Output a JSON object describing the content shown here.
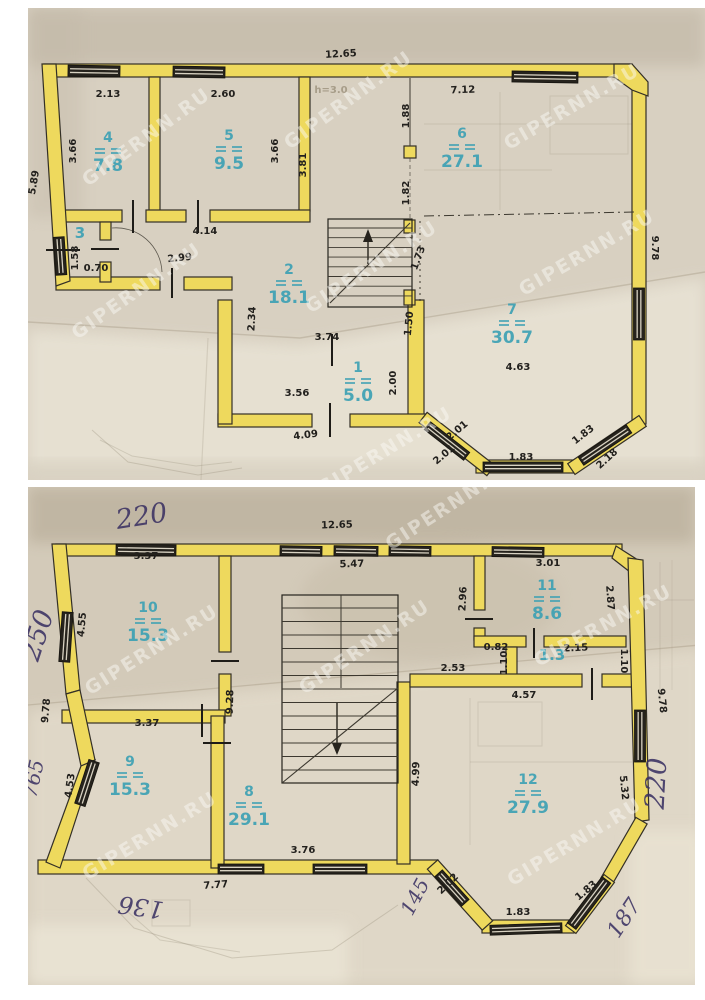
{
  "watermark_text": "GIPERNN.RU",
  "colors": {
    "wall_yellow": "#eed95d",
    "room_label_teal": "#3aa0b4",
    "dimension_ink": "#22201d",
    "handwriting_ink": "#3b3263"
  },
  "floor1": {
    "rooms": [
      {
        "num": "1",
        "area": "5.0",
        "x": 358,
        "y": 372
      },
      {
        "num": "2",
        "area": "18.1",
        "x": 289,
        "y": 274
      },
      {
        "num": "3",
        "x": 80,
        "y": 238
      },
      {
        "num": "4",
        "area": "7.8",
        "x": 108,
        "y": 142
      },
      {
        "num": "5",
        "area": "9.5",
        "x": 229,
        "y": 140
      },
      {
        "num": "6",
        "area": "27.1",
        "x": 462,
        "y": 138
      },
      {
        "num": "7",
        "area": "30.7",
        "x": 512,
        "y": 314
      }
    ],
    "dims": [
      {
        "t": "12.65",
        "x": 341,
        "y": 57,
        "r": -3
      },
      {
        "t": "2.13",
        "x": 108,
        "y": 97
      },
      {
        "t": "2.60",
        "x": 223,
        "y": 97
      },
      {
        "t": "h=3.0",
        "x": 331,
        "y": 93,
        "ghost": true
      },
      {
        "t": "7.12",
        "x": 463,
        "y": 93,
        "r": -2
      },
      {
        "t": "3.66",
        "x": 76,
        "y": 151,
        "r": -90
      },
      {
        "t": "3.66",
        "x": 278,
        "y": 151,
        "r": -90
      },
      {
        "t": "3.81",
        "x": 306,
        "y": 165,
        "r": -90
      },
      {
        "t": "5.89",
        "x": 37,
        "y": 183,
        "r": -80
      },
      {
        "t": "1.88",
        "x": 409,
        "y": 116,
        "r": -90
      },
      {
        "t": "1.82",
        "x": 409,
        "y": 193,
        "r": -90
      },
      {
        "t": "1.73",
        "x": 421,
        "y": 259,
        "r": -70
      },
      {
        "t": "1.50",
        "x": 412,
        "y": 324,
        "r": -84
      },
      {
        "t": "4.14",
        "x": 205,
        "y": 234
      },
      {
        "t": "2.99",
        "x": 180,
        "y": 261,
        "r": -6
      },
      {
        "t": "1.58",
        "x": 78,
        "y": 258,
        "r": -90
      },
      {
        "t": "0.70",
        "x": 96,
        "y": 271
      },
      {
        "t": "2.34",
        "x": 255,
        "y": 319,
        "r": -87
      },
      {
        "t": "3.74",
        "x": 327,
        "y": 340
      },
      {
        "t": "3.56",
        "x": 297,
        "y": 396
      },
      {
        "t": "2.00",
        "x": 396,
        "y": 383,
        "r": -90
      },
      {
        "t": "4.09",
        "x": 306,
        "y": 438,
        "r": -7
      },
      {
        "t": "2.01",
        "x": 459,
        "y": 433,
        "r": -40
      },
      {
        "t": "2.01",
        "x": 446,
        "y": 457,
        "r": -40
      },
      {
        "t": "1.83",
        "x": 521,
        "y": 460
      },
      {
        "t": "1.83",
        "x": 585,
        "y": 437,
        "r": -38
      },
      {
        "t": "2.18",
        "x": 609,
        "y": 461,
        "r": -42
      },
      {
        "t": "9.78",
        "x": 652,
        "y": 248,
        "r": 90
      },
      {
        "t": "4.63",
        "x": 518,
        "y": 370
      }
    ],
    "watermarks": [
      [
        150,
        142,
        -36
      ],
      [
        352,
        105,
        -36
      ],
      [
        575,
        112,
        -30
      ],
      [
        140,
        296,
        -35
      ],
      [
        375,
        272,
        -33
      ],
      [
        590,
        258,
        -30
      ],
      [
        388,
        456,
        -31
      ]
    ],
    "handwritten": []
  },
  "floor2": {
    "rooms": [
      {
        "num": "10",
        "area": "15.3",
        "x": 148,
        "y": 612
      },
      {
        "num": "11",
        "area": "8.6",
        "x": 547,
        "y": 590
      },
      {
        "num": "1.3",
        "x": 552,
        "y": 660
      },
      {
        "num": "9",
        "area": "15.3",
        "x": 130,
        "y": 766
      },
      {
        "num": "8",
        "area": "29.1",
        "x": 249,
        "y": 796
      },
      {
        "num": "12",
        "area": "27.9",
        "x": 528,
        "y": 784
      }
    ],
    "dims": [
      {
        "t": "12.65",
        "x": 337,
        "y": 528,
        "r": -2
      },
      {
        "t": "3.37",
        "x": 146,
        "y": 559
      },
      {
        "t": "5.47",
        "x": 352,
        "y": 567,
        "r": -2
      },
      {
        "t": "3.01",
        "x": 548,
        "y": 566
      },
      {
        "t": "4.55",
        "x": 85,
        "y": 625,
        "r": -85
      },
      {
        "t": "2.96",
        "x": 466,
        "y": 599,
        "r": -87
      },
      {
        "t": "2.87",
        "x": 607,
        "y": 598,
        "r": 86
      },
      {
        "t": "9.28",
        "x": 233,
        "y": 702,
        "r": -88
      },
      {
        "t": "0.82",
        "x": 496,
        "y": 650
      },
      {
        "t": "2.15",
        "x": 576,
        "y": 651,
        "r": -3
      },
      {
        "t": "1.10",
        "x": 507,
        "y": 663,
        "r": -90
      },
      {
        "t": "1.10",
        "x": 621,
        "y": 661,
        "r": 90
      },
      {
        "t": "2.53",
        "x": 453,
        "y": 671
      },
      {
        "t": "4.57",
        "x": 524,
        "y": 698
      },
      {
        "t": "3.37",
        "x": 147,
        "y": 726
      },
      {
        "t": "9.78",
        "x": 49,
        "y": 711,
        "r": -85
      },
      {
        "t": "4.53",
        "x": 73,
        "y": 786,
        "r": -82
      },
      {
        "t": "4.99",
        "x": 419,
        "y": 774,
        "r": -88
      },
      {
        "t": "5.32",
        "x": 621,
        "y": 788,
        "r": 84
      },
      {
        "t": "3.76",
        "x": 303,
        "y": 853
      },
      {
        "t": "7.77",
        "x": 216,
        "y": 888,
        "r": -4
      },
      {
        "t": "2.02",
        "x": 450,
        "y": 886,
        "r": -44
      },
      {
        "t": "1.83",
        "x": 518,
        "y": 915
      },
      {
        "t": "1.83",
        "x": 588,
        "y": 893,
        "r": -40
      },
      {
        "t": "9.78",
        "x": 659,
        "y": 701,
        "r": 84
      }
    ],
    "watermarks": [
      [
        455,
        509,
        -33
      ],
      [
        155,
        655,
        -32
      ],
      [
        368,
        652,
        -34
      ],
      [
        606,
        631,
        -28
      ],
      [
        153,
        841,
        -31
      ],
      [
        578,
        847,
        -31
      ]
    ],
    "handwritten": [
      {
        "t": "220",
        "x": 143,
        "y": 525,
        "r": -9,
        "s": 27
      },
      {
        "t": "250",
        "x": 46,
        "y": 638,
        "r": -72,
        "s": 27
      },
      {
        "t": "765",
        "x": 40,
        "y": 780,
        "r": -78,
        "s": 20
      },
      {
        "t": "136",
        "x": 142,
        "y": 899,
        "r": 188,
        "s": 24
      },
      {
        "t": "145",
        "x": 421,
        "y": 900,
        "r": -62,
        "s": 20
      },
      {
        "t": "187",
        "x": 630,
        "y": 922,
        "r": -56,
        "s": 22
      },
      {
        "t": "220",
        "x": 665,
        "y": 784,
        "r": -87,
        "s": 27
      }
    ]
  }
}
